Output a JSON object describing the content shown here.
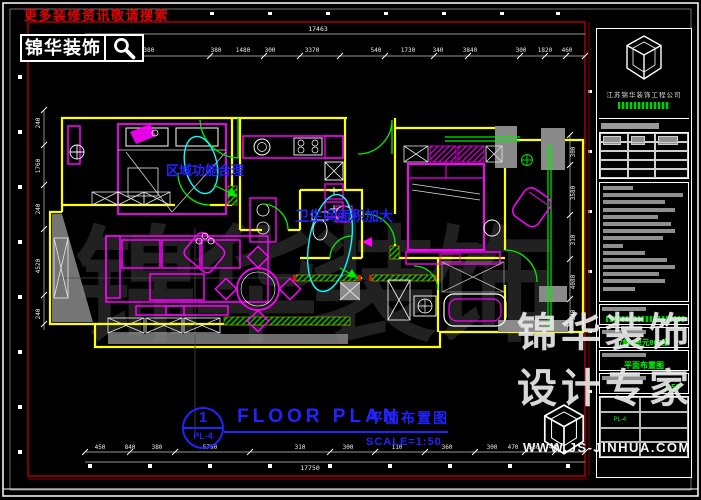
{
  "header": {
    "slogan": "更多装修资讯敬请搜索",
    "brand": "锦华装饰",
    "search_icon": "magnifier"
  },
  "plan": {
    "annotation_zone": "区域功能合理",
    "annotation_bath": "卫生间面积加大",
    "background_watermark": "锦华装饰"
  },
  "dimensions": {
    "top_total": "17463",
    "top": [
      "4380",
      "380",
      "1480",
      "300",
      "3370",
      "540",
      "1730",
      "340",
      "3840",
      "300",
      "1820",
      "460"
    ],
    "bottom": [
      "450",
      "840",
      "380",
      "5790",
      "310",
      "300",
      "110",
      "360",
      "300",
      "470",
      "530",
      "440"
    ],
    "bottom_total": "17750",
    "left": [
      "240",
      "1760",
      "240",
      "4520",
      "240"
    ],
    "right": [
      "300",
      "3580",
      "310",
      "4080",
      "340"
    ]
  },
  "title_bar": {
    "number": "1",
    "sheet_code": "PL-4",
    "title_en": "FLOOR PLAN",
    "title_cn": "平面布置图",
    "scale": "SCALE=1:50"
  },
  "title_block": {
    "company": "江苏锦华装饰工程公司",
    "project_value": "7幢1单元803室",
    "drawing_name": "平面布置图",
    "scale_value": "1:50",
    "sheet_no": "PL-4"
  },
  "watermark": {
    "line1": "锦华装饰",
    "line2": "设计专家",
    "url": "WWW.JS-JINHUA.COM"
  },
  "colors": {
    "wall_yellow": "#ffff00",
    "furniture_magenta": "#ff00ff",
    "door_green": "#00ee00",
    "highlight_cyan": "#00ffff",
    "text_blue": "#2323ff",
    "frame_red": "#8c0008",
    "slogan_red": "#e60000",
    "titleblock_green": "#00ff00"
  }
}
